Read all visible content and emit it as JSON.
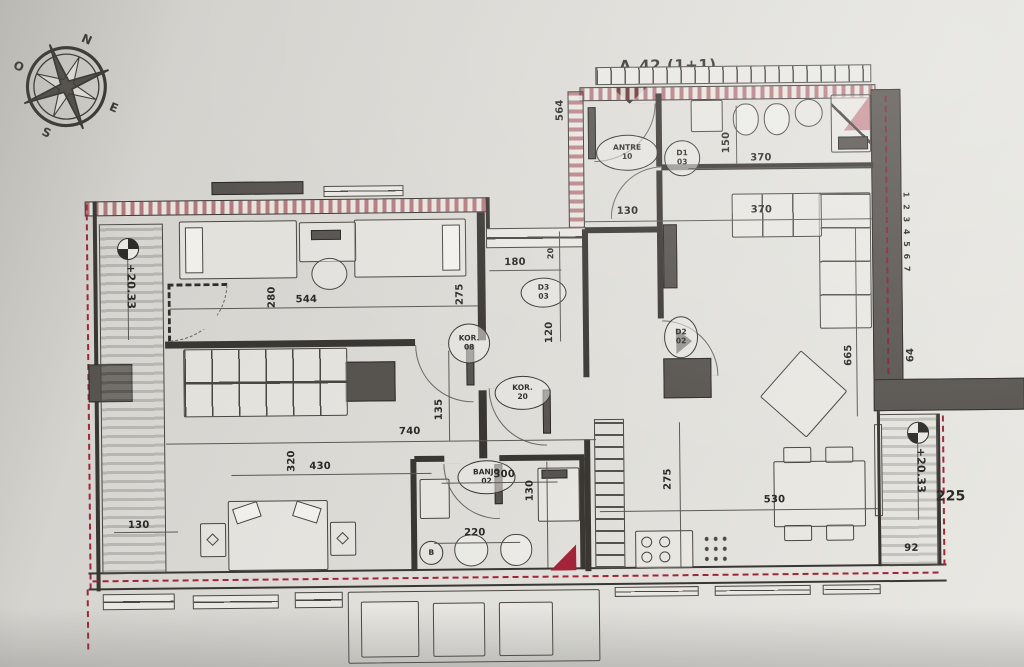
{
  "meta": {
    "colors": {
      "paper": "#dcdad5",
      "ink": "#3a3733",
      "structural_wall": "#57534e",
      "insulation_red": "#a22438",
      "accent_red": "#b02a42"
    }
  },
  "title": "A_42 (1+1)",
  "compass": {
    "n": "N",
    "o": "O",
    "s": "S",
    "e": "E"
  },
  "levels": [
    "+20.33",
    "+20.33"
  ],
  "wall_ticks": "1 2 3 4 5 6 7",
  "dims": [
    "544",
    "280",
    "275",
    "180",
    "20",
    "120",
    "130",
    "370",
    "150",
    "370",
    "564",
    "740",
    "320",
    "430",
    "135",
    "300",
    "130",
    "220",
    "275",
    "530",
    "665",
    "64",
    "92",
    "225",
    "130"
  ],
  "tags": [
    {
      "t": "ANTRE",
      "b": "10"
    },
    {
      "t": "D1",
      "b": "03"
    },
    {
      "t": "D3",
      "b": "03"
    },
    {
      "t": "KOR.",
      "b": "08"
    },
    {
      "t": "KOR.",
      "b": "20"
    },
    {
      "t": "BANJO",
      "b": "02"
    },
    {
      "t": "D2",
      "b": "02"
    },
    {
      "t": "B",
      "b": ""
    }
  ]
}
